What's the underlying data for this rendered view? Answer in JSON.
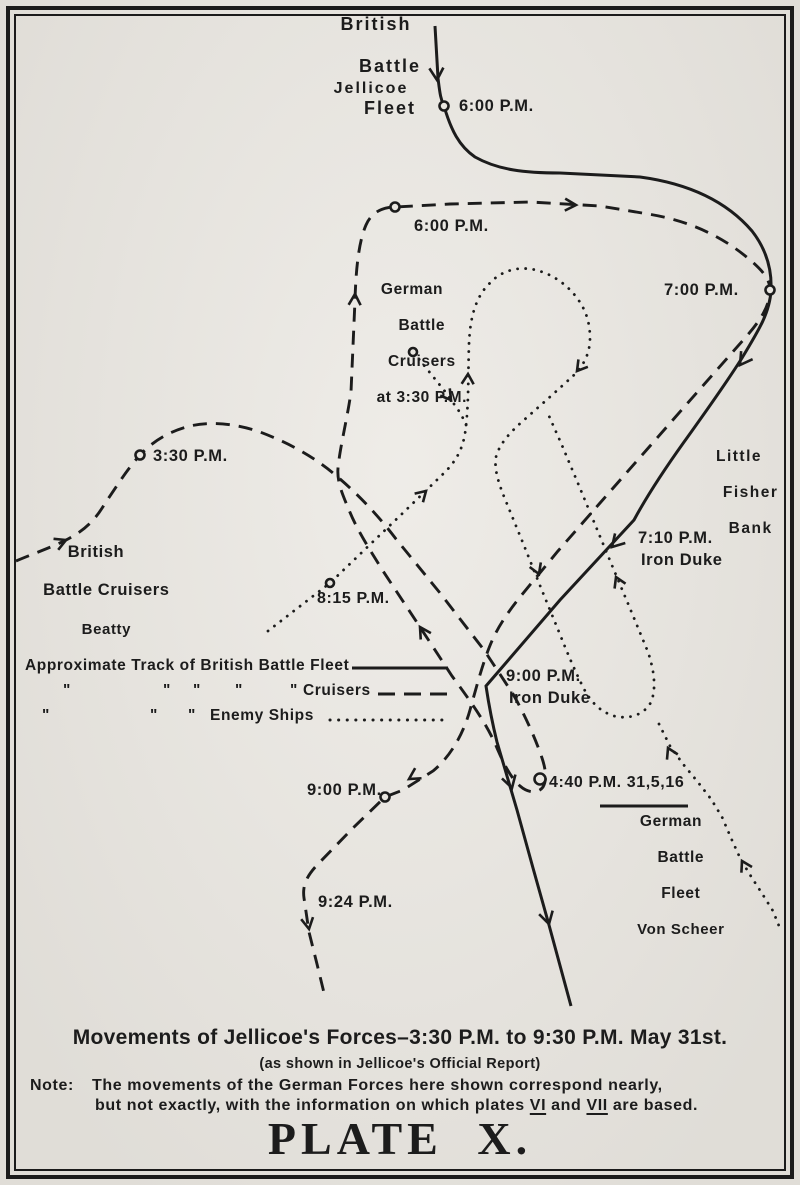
{
  "colors": {
    "paper": "#e9e6e0",
    "ink": "#1c1c1c"
  },
  "fleet_labels": {
    "british_battle_fleet": [
      "British",
      "Battle",
      "Fleet"
    ],
    "jellicoe": "Jellicoe",
    "german_battle_cruisers": [
      "German",
      "Battle",
      "Cruisers",
      "at 3:30 P.M."
    ],
    "little_fisher_bank": [
      "Little",
      "Fisher",
      "Bank"
    ],
    "british_battle_cruisers": [
      "British",
      "Battle Cruisers",
      "Beatty"
    ],
    "german_battle_fleet": [
      "German",
      "Battle",
      "Fleet",
      "Von Scheer"
    ]
  },
  "time_labels": {
    "t600_fleet": "6:00 P.M.",
    "t600_cruisers": "6:00 P.M.",
    "t700": "7:00 P.M.",
    "t710": "7:10 P.M.",
    "t710_ship": "Iron Duke",
    "t330": "3:30 P.M.",
    "t815": "8:15 P.M.",
    "t900_fleet": "9:00 P.M.",
    "t900_ship": "Iron Duke",
    "t440": "4:40 P.M. 31,5,16",
    "t900_cruisers": "9:00 P.M.",
    "t924": "9:24 P.M."
  },
  "legend": {
    "line1": "Approximate Track of British Battle Fleet",
    "ditto": "\"",
    "line2_label": "Cruisers",
    "line3_label": "Enemy Ships"
  },
  "caption": {
    "title": "Movements of Jellicoe's Forces–3:30 P.M. to 9:30 P.M. May 31st.",
    "subtitle": "(as shown in Jellicoe's Official Report)",
    "note_label": "Note:",
    "note_line1": "The movements of the German Forces here shown correspond nearly,",
    "note_line2_pre": "but not exactly, with the information on which plates ",
    "note_plate1": "VI",
    "note_and": " and ",
    "note_plate2": "VII",
    "note_line2_post": " are based.",
    "plate": "PLATE X."
  }
}
